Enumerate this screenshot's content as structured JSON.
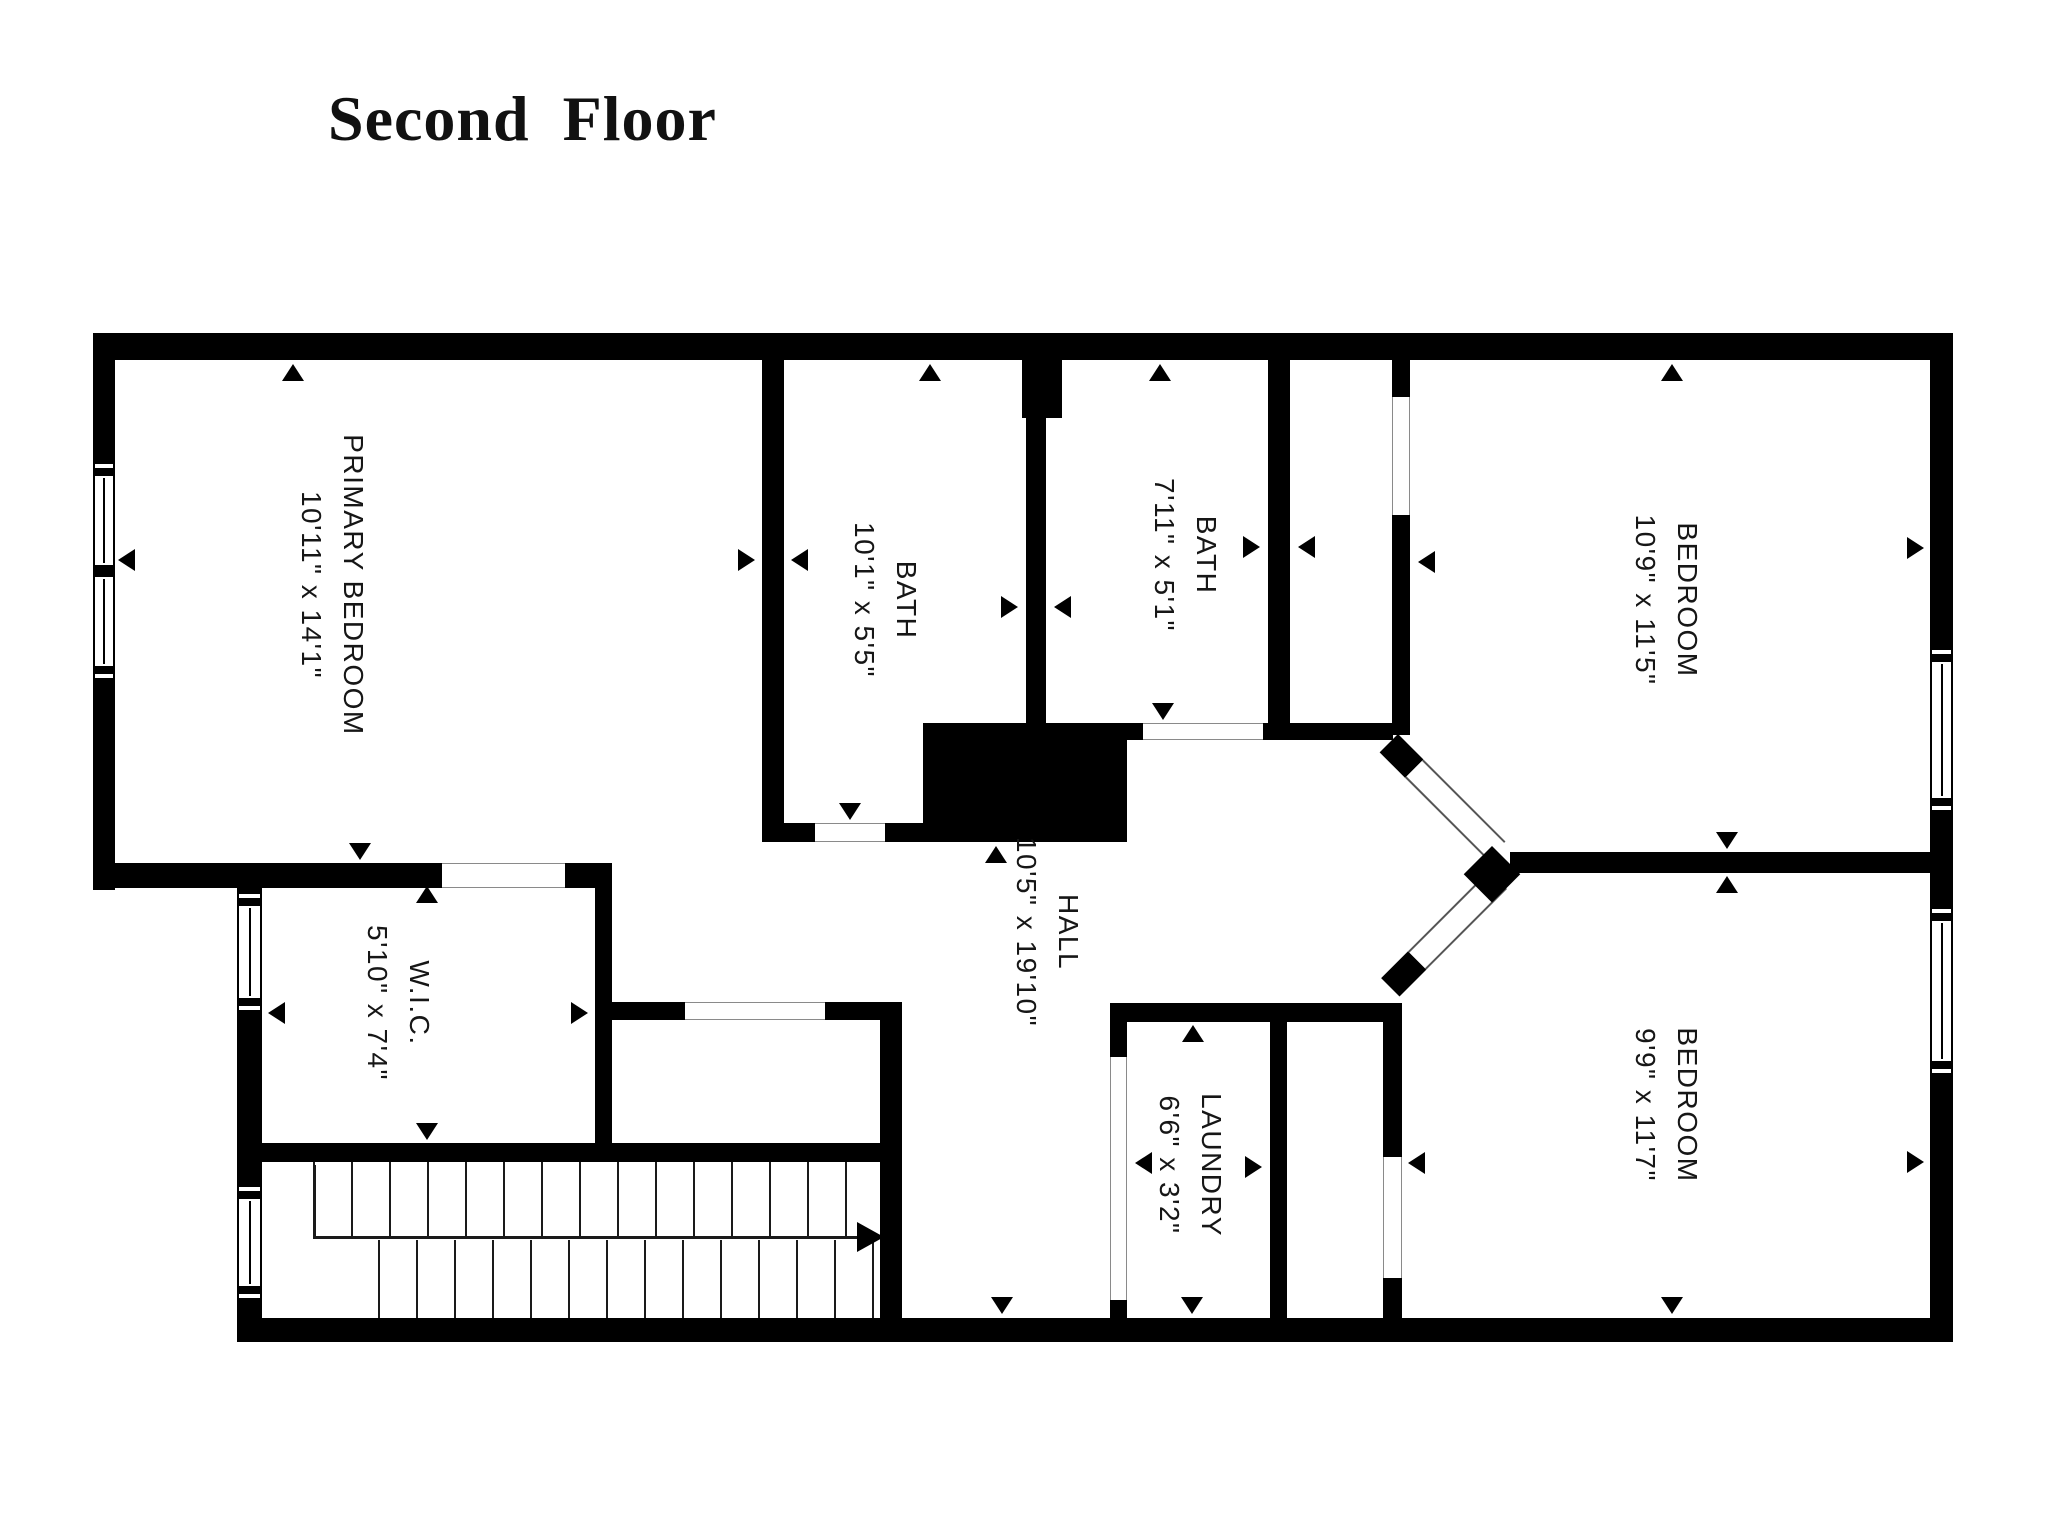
{
  "title": "Second Floor",
  "rooms": [
    {
      "id": "primary-bedroom",
      "name": "PRIMARY BEDROOM",
      "dims": "10'11\" x 14'1\""
    },
    {
      "id": "bath-1",
      "name": "BATH",
      "dims": "10'1\" x 5'5\""
    },
    {
      "id": "bath-2",
      "name": "BATH",
      "dims": "7'11\" x 5'1\""
    },
    {
      "id": "bedroom-top-right",
      "name": "BEDROOM",
      "dims": "10'9\" x 11'5\""
    },
    {
      "id": "wic",
      "name": "W.I.C.",
      "dims": "5'10\" x 7'4\""
    },
    {
      "id": "hall",
      "name": "HALL",
      "dims": "10'5\" x 19'10\""
    },
    {
      "id": "laundry",
      "name": "LAUNDRY",
      "dims": "6'6\" x 3'2\""
    },
    {
      "id": "bedroom-bottom-right",
      "name": "BEDROOM",
      "dims": "9'9\" x 11'7\""
    }
  ],
  "colors": {
    "wall": "#000000",
    "background": "#ffffff",
    "text": "#161616"
  }
}
